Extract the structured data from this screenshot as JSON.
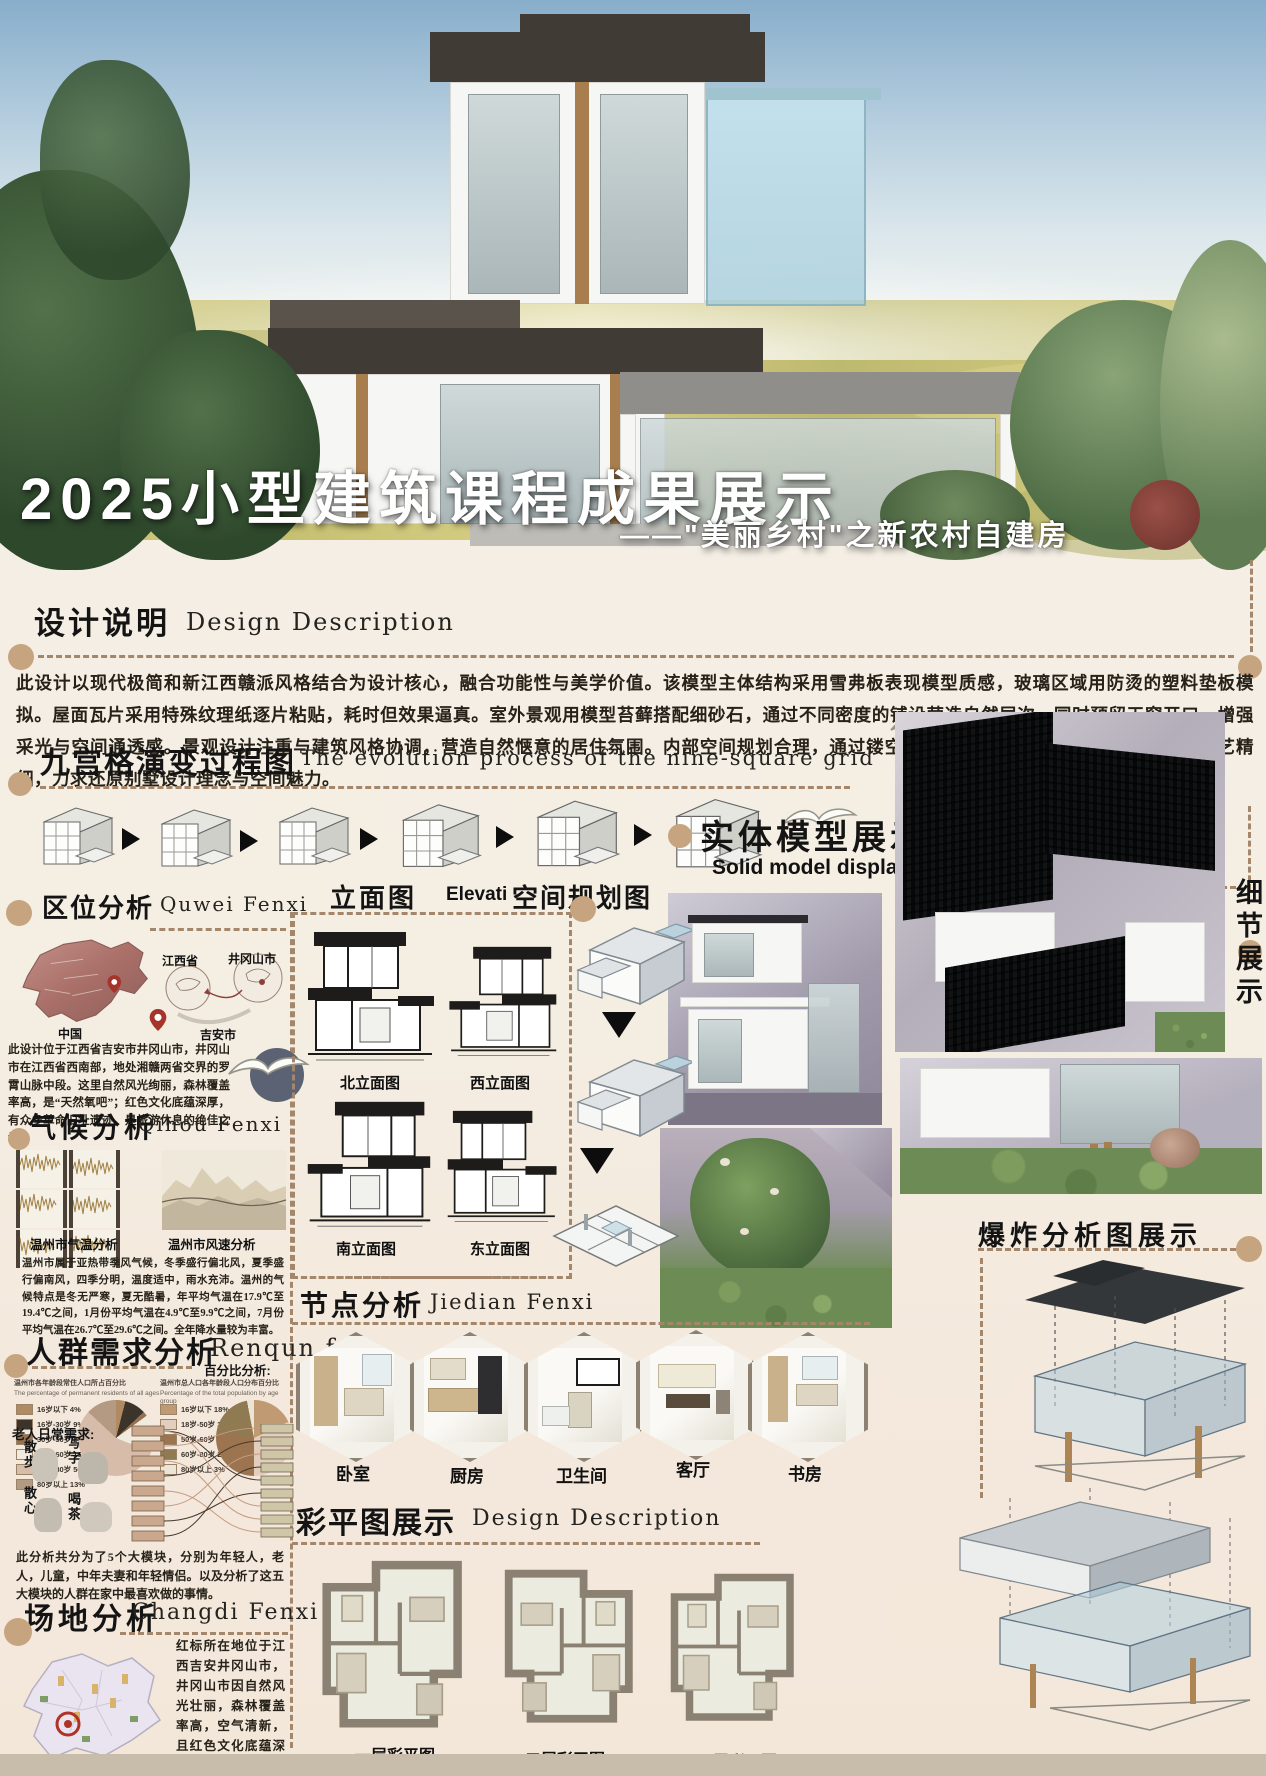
{
  "poster": {
    "title": "2025小型建筑课程成果展示",
    "subtitle": "——\"美丽乡村\"之新农村自建房"
  },
  "sections": {
    "design_description": {
      "heading_cn": "设计说明",
      "heading_en": "Design Description",
      "body": "此设计以现代极简和新江西赣派风格结合为设计核心，融合功能性与美学价值。该模型主体结构采用雪弗板表现模型质感，玻璃区域用防烫的塑料垫板模拟。屋面瓦片采用特殊纹理纸逐片粘贴，耗时但效果逼真。室外景观用模型苔藓搭配细砂石，通过不同密度的铺设营造自然层次。同时预留天窗开口，增强采光与空间通透感。景观设计注重与建筑风格协调，营造自然惬意的居住氛围。内部空间规划合理，通过镂空展示客厅、卧室等功能区。整体制作工艺精细，力求还原别墅设计理念与空间魅力。"
    },
    "nine_grid": {
      "heading_cn": "九宫格演变过程图",
      "heading_en": "The evolution process of the nine-square grid"
    },
    "location": {
      "heading_cn": "区位分析",
      "heading_en": "Quwei Fenxi",
      "map_labels": [
        "中国",
        "江西省",
        "井冈山市",
        "吉安市"
      ],
      "body": "此设计位于江西省吉安市井冈山市，井冈山市在江西省西南部，地处湘赣两省交界的罗霄山脉中段。这里自然风光绚丽，森林覆盖率高，是“天然氧吧”；红色文化底蕴深厚，有众多革命旧址遗迹，是旅游休息的绝佳之地。"
    },
    "climate": {
      "heading_cn": "气候分析",
      "heading_en": "Qihou Fenxi",
      "caption_left": "温州市气温分析",
      "caption_right": "温州市风速分析",
      "body": "温州市属于亚热带季风气候，冬季盛行偏北风，夏季盛行偏南风，四季分明，温度适中，雨水充沛。温州的气候特点是冬无严寒，夏无酷暑，年平均气温在17.9℃至19.4℃之间，1月份平均气温在4.9℃至9.9℃之间，7月份平均气温在26.7℃至29.6℃之间。全年降水量较为丰富。"
    },
    "crowd": {
      "heading_cn": "人群需求分析",
      "heading_en": "Renqun fe",
      "percent_label": "百分比分析:",
      "elder_needs_label": "老人日常需求:",
      "elder_needs": [
        "散步",
        "写字",
        "散心",
        "喝茶"
      ],
      "body": "此分析共分为了5个大模块，分别为年轻人，老人，儿童，中年夫妻和年轻情侣。以及分析了这五大模块的人群在家中最喜欢做的事情。"
    },
    "site": {
      "heading_cn": "场地分析",
      "heading_en": "Changdi Fenxi",
      "body": "红标所在地位于江西吉安井冈山市，井冈山市因自然风光壮丽，森林覆盖率高，空气清新，且红色文化底蕴深厚，革命历史遗址丰富，兼具自然美景与人文底蕴，适合人们旅游和养老生活。"
    },
    "elevation": {
      "heading_cn": "立面图",
      "heading_en": "Elevation",
      "labels": [
        "北立面图",
        "西立面图",
        "南立面图",
        "东立面图"
      ]
    },
    "space_plan": {
      "heading_cn": "空间规划图"
    },
    "node": {
      "heading_cn": "节点分析",
      "heading_en": "Jiedian Fenxi",
      "rooms": [
        "卧室",
        "厨房",
        "卫生间",
        "客厅",
        "书房"
      ]
    },
    "color_plan": {
      "heading_cn": "彩平图展示",
      "heading_en": "Design Description",
      "labels": [
        "一层彩平图",
        "二层彩平图",
        "三层彩平图"
      ]
    },
    "solid_model": {
      "heading_cn": "实体模型展示",
      "heading_en": "Solid model display"
    },
    "detail_display": {
      "heading_cn": "细节展示"
    },
    "explode": {
      "heading_cn": "爆炸分析图展示"
    }
  },
  "chart_data": [
    {
      "type": "pie",
      "title": "温州市各年龄段常住人口所占百分比",
      "subtitle": "The percentage of permanent residents of all ages",
      "labels": [
        "16岁以下",
        "16岁-30岁",
        "30岁-50岁",
        "50岁-60岁",
        "60岁-80岁",
        "80岁以上"
      ],
      "values": [
        4,
        9,
        2,
        16,
        56,
        13
      ],
      "colors": [
        "#b08a62",
        "#3c332a",
        "#96714f",
        "#f1eadf",
        "#d7bda9",
        "#b49a82"
      ],
      "legend_position": "left"
    },
    {
      "type": "pie",
      "title": "温州市总人口各年龄段人口分布百分比",
      "subtitle": "Percentage of the total population by age group",
      "labels": [
        "16岁以下",
        "18岁-50岁",
        "50岁-60岁",
        "60岁-80岁",
        "80岁以上"
      ],
      "values": [
        18,
        32,
        27,
        20,
        3
      ],
      "colors": [
        "#c09a72",
        "#e3cdbd",
        "#9c7550",
        "#8f7a52",
        "#ece4d6"
      ],
      "legend_position": "left"
    }
  ]
}
